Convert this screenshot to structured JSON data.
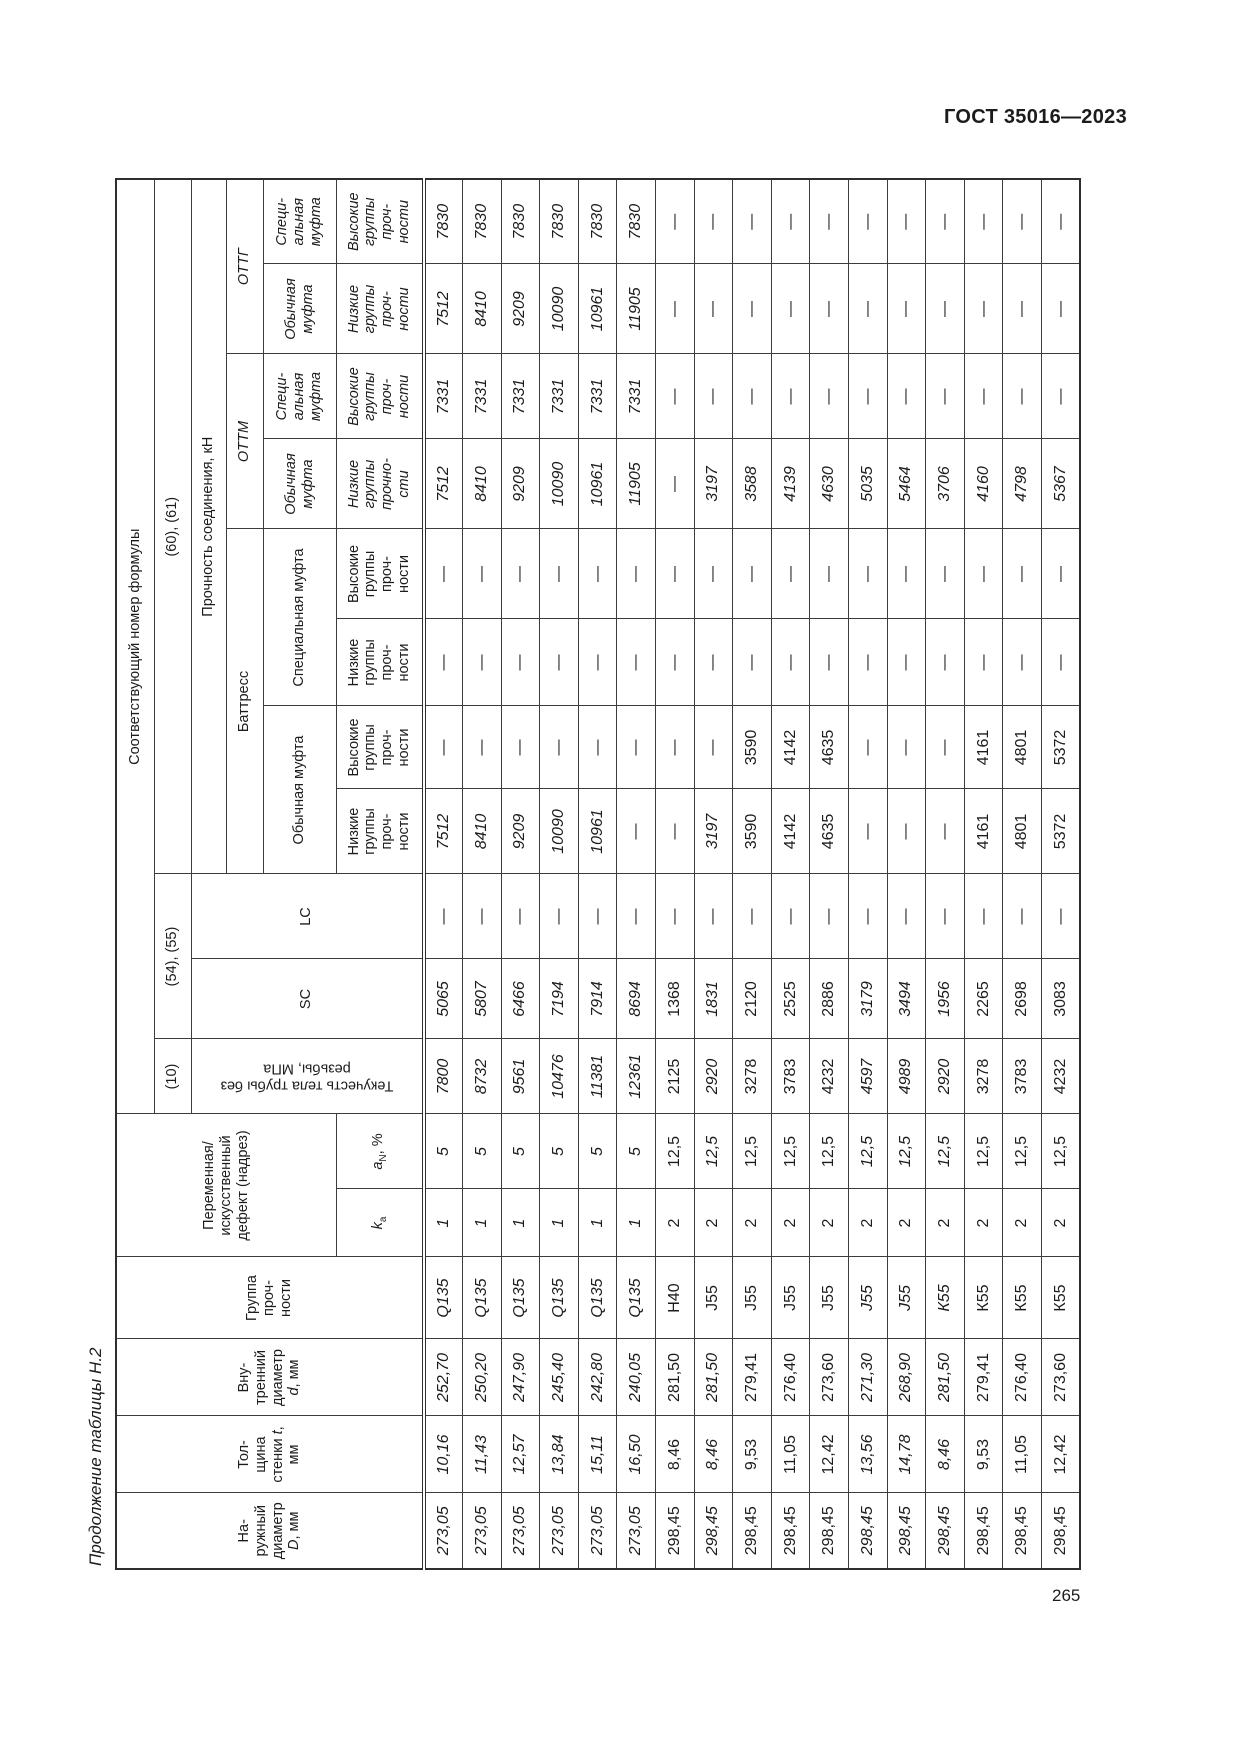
{
  "page": {
    "header": "ГОСТ 35016—2023",
    "page_number": "265",
    "table_title": "Продолжение таблицы Н.2"
  },
  "hdr": {
    "outer": {
      "a": "На-\nружный\nдиаметр\n",
      "b": "D",
      "c": ", мм"
    },
    "wall": {
      "a": "Тол-\nщина\nстенки ",
      "b": "t",
      "c": ",\nмм"
    },
    "inner": {
      "a": "Вну-\nтренний\nдиаметр\n",
      "b": "d",
      "c": ", мм"
    },
    "grade": "Группа\nпроч-\nности",
    "defect": "Переменная/\nискусственный\nдефект (надрез)",
    "ka": {
      "b": "k",
      "s": "a"
    },
    "an": {
      "b": "a",
      "s": "N",
      "u": ", %"
    },
    "formula_group": "Соответствующий номер формулы",
    "f10": "(10)",
    "f5455": "(54), (55)",
    "f6061": "(60), (61)",
    "yield": "Текучесть тела трубы без\nрезьбы, МПа",
    "sc": "SC",
    "lc": "LC",
    "strength": "Прочность соединения, кН",
    "buttress": "Баттресс",
    "ottm": "ОТТМ",
    "ottg": "ОТТГ",
    "usual_one_line": "Обычная муфта",
    "special_one_line": "Специальная муфта",
    "usual_two_line": "Обычная\nмуфта",
    "special_three_line": "Специ-\nальная\nмуфта",
    "low_groups": "Низкие\nгруппы\nпроч-\nности",
    "high_groups": "Высокие\nгруппы\nпроч-\nности",
    "low_groups_alt": "Низкие\nгруппы\nпрочно-\nсти"
  },
  "table": {
    "rows": [
      [
        {
          "v": "273,05",
          "i": 1
        },
        {
          "v": "10,16",
          "i": 1
        },
        {
          "v": "252,70",
          "i": 1
        },
        {
          "v": "Q135",
          "i": 1
        },
        {
          "v": "1",
          "i": 1
        },
        {
          "v": "5",
          "i": 1
        },
        {
          "v": "7800",
          "i": 1
        },
        {
          "v": "5065",
          "i": 1
        },
        "—",
        {
          "v": "7512",
          "i": 1
        },
        "—",
        "—",
        "—",
        {
          "v": "7512",
          "i": 1
        },
        {
          "v": "7331",
          "i": 1
        },
        {
          "v": "7512",
          "i": 1
        },
        {
          "v": "7830",
          "i": 1
        }
      ],
      [
        {
          "v": "273,05",
          "i": 1
        },
        {
          "v": "11,43",
          "i": 1
        },
        {
          "v": "250,20",
          "i": 1
        },
        {
          "v": "Q135",
          "i": 1
        },
        {
          "v": "1",
          "i": 1
        },
        {
          "v": "5",
          "i": 1
        },
        {
          "v": "8732",
          "i": 1
        },
        {
          "v": "5807",
          "i": 1
        },
        "—",
        {
          "v": "8410",
          "i": 1
        },
        "—",
        "—",
        "—",
        {
          "v": "8410",
          "i": 1
        },
        {
          "v": "7331",
          "i": 1
        },
        {
          "v": "8410",
          "i": 1
        },
        {
          "v": "7830",
          "i": 1
        }
      ],
      [
        {
          "v": "273,05",
          "i": 1
        },
        {
          "v": "12,57",
          "i": 1
        },
        {
          "v": "247,90",
          "i": 1
        },
        {
          "v": "Q135",
          "i": 1
        },
        {
          "v": "1",
          "i": 1
        },
        {
          "v": "5",
          "i": 1
        },
        {
          "v": "9561",
          "i": 1
        },
        {
          "v": "6466",
          "i": 1
        },
        "—",
        {
          "v": "9209",
          "i": 1
        },
        "—",
        "—",
        "—",
        {
          "v": "9209",
          "i": 1
        },
        {
          "v": "7331",
          "i": 1
        },
        {
          "v": "9209",
          "i": 1
        },
        {
          "v": "7830",
          "i": 1
        }
      ],
      [
        {
          "v": "273,05",
          "i": 1
        },
        {
          "v": "13,84",
          "i": 1
        },
        {
          "v": "245,40",
          "i": 1
        },
        {
          "v": "Q135",
          "i": 1
        },
        {
          "v": "1",
          "i": 1
        },
        {
          "v": "5",
          "i": 1
        },
        {
          "v": "10476",
          "i": 1
        },
        {
          "v": "7194",
          "i": 1
        },
        "—",
        {
          "v": "10090",
          "i": 1
        },
        "—",
        "—",
        "—",
        {
          "v": "10090",
          "i": 1
        },
        {
          "v": "7331",
          "i": 1
        },
        {
          "v": "10090",
          "i": 1
        },
        {
          "v": "7830",
          "i": 1
        }
      ],
      [
        {
          "v": "273,05",
          "i": 1
        },
        {
          "v": "15,11",
          "i": 1
        },
        {
          "v": "242,80",
          "i": 1
        },
        {
          "v": "Q135",
          "i": 1
        },
        {
          "v": "1",
          "i": 1
        },
        {
          "v": "5",
          "i": 1
        },
        {
          "v": "11381",
          "i": 1
        },
        {
          "v": "7914",
          "i": 1
        },
        "—",
        {
          "v": "10961",
          "i": 1
        },
        "—",
        "—",
        "—",
        {
          "v": "10961",
          "i": 1
        },
        {
          "v": "7331",
          "i": 1
        },
        {
          "v": "10961",
          "i": 1
        },
        {
          "v": "7830",
          "i": 1
        }
      ],
      [
        {
          "v": "273,05",
          "i": 1
        },
        {
          "v": "16,50",
          "i": 1
        },
        {
          "v": "240,05",
          "i": 1
        },
        {
          "v": "Q135",
          "i": 1
        },
        {
          "v": "1",
          "i": 1
        },
        {
          "v": "5",
          "i": 1
        },
        {
          "v": "12361",
          "i": 1
        },
        {
          "v": "8694",
          "i": 1
        },
        "—",
        "—",
        "—",
        "—",
        "—",
        {
          "v": "11905",
          "i": 1
        },
        {
          "v": "7331",
          "i": 1
        },
        {
          "v": "11905",
          "i": 1
        },
        {
          "v": "7830",
          "i": 1
        }
      ],
      [
        "298,45",
        "8,46",
        "281,50",
        "Н40",
        "2",
        "12,5",
        "2125",
        "1368",
        "—",
        "—",
        "—",
        "—",
        "—",
        "—",
        "—",
        "—",
        "—"
      ],
      [
        {
          "v": "298,45",
          "i": 1
        },
        {
          "v": "8,46",
          "i": 1
        },
        {
          "v": "281,50",
          "i": 1
        },
        "J55",
        "2",
        {
          "v": "12,5",
          "i": 1
        },
        {
          "v": "2920",
          "i": 1
        },
        {
          "v": "1831",
          "i": 1
        },
        "—",
        {
          "v": "3197",
          "i": 1
        },
        "—",
        "—",
        "—",
        {
          "v": "3197",
          "i": 1
        },
        "—",
        "—",
        "—"
      ],
      [
        "298,45",
        "9,53",
        "279,41",
        "J55",
        "2",
        "12,5",
        "3278",
        "2120",
        "—",
        "3590",
        "3590",
        "—",
        "—",
        {
          "v": "3588",
          "i": 1
        },
        "—",
        "—",
        "—"
      ],
      [
        "298,45",
        "11,05",
        "276,40",
        "J55",
        "2",
        "12,5",
        "3783",
        "2525",
        "—",
        "4142",
        "4142",
        "—",
        "—",
        {
          "v": "4139",
          "i": 1
        },
        "—",
        "—",
        "—"
      ],
      [
        "298,45",
        "12,42",
        "273,60",
        "J55",
        "2",
        "12,5",
        "4232",
        "2886",
        "—",
        "4635",
        "4635",
        "—",
        "—",
        {
          "v": "4630",
          "i": 1
        },
        "—",
        "—",
        "—"
      ],
      [
        {
          "v": "298,45",
          "i": 1
        },
        {
          "v": "13,56",
          "i": 1
        },
        {
          "v": "271,30",
          "i": 1
        },
        {
          "v": "J55",
          "i": 1
        },
        "2",
        {
          "v": "12,5",
          "i": 1
        },
        {
          "v": "4597",
          "i": 1
        },
        {
          "v": "3179",
          "i": 1
        },
        "—",
        "—",
        "—",
        "—",
        "—",
        {
          "v": "5035",
          "i": 1
        },
        "—",
        "—",
        "—"
      ],
      [
        {
          "v": "298,45",
          "i": 1
        },
        {
          "v": "14,78",
          "i": 1
        },
        {
          "v": "268,90",
          "i": 1
        },
        {
          "v": "J55",
          "i": 1
        },
        "2",
        {
          "v": "12,5",
          "i": 1
        },
        {
          "v": "4989",
          "i": 1
        },
        {
          "v": "3494",
          "i": 1
        },
        "—",
        "—",
        "—",
        "—",
        "—",
        {
          "v": "5464",
          "i": 1
        },
        "—",
        "—",
        "—"
      ],
      [
        {
          "v": "298,45",
          "i": 1
        },
        {
          "v": "8,46",
          "i": 1
        },
        {
          "v": "281,50",
          "i": 1
        },
        {
          "v": "К55",
          "i": 1
        },
        "2",
        {
          "v": "12,5",
          "i": 1
        },
        {
          "v": "2920",
          "i": 1
        },
        {
          "v": "1956",
          "i": 1
        },
        "—",
        "—",
        "—",
        "—",
        "—",
        {
          "v": "3706",
          "i": 1
        },
        "—",
        "—",
        "—"
      ],
      [
        "298,45",
        "9,53",
        "279,41",
        "К55",
        "2",
        "12,5",
        "3278",
        "2265",
        "—",
        "4161",
        "4161",
        "—",
        "—",
        {
          "v": "4160",
          "i": 1
        },
        "—",
        "—",
        "—"
      ],
      [
        "298,45",
        "11,05",
        "276,40",
        "К55",
        "2",
        "12,5",
        "3783",
        "2698",
        "—",
        "4801",
        "4801",
        "—",
        "—",
        {
          "v": "4798",
          "i": 1
        },
        "—",
        "—",
        "—"
      ],
      [
        "298,45",
        "12,42",
        "273,60",
        "К55",
        "2",
        "12,5",
        "4232",
        "3083",
        "—",
        "5372",
        "5372",
        "—",
        "—",
        {
          "v": "5367",
          "i": 1
        },
        "—",
        "—",
        "—"
      ]
    ]
  }
}
